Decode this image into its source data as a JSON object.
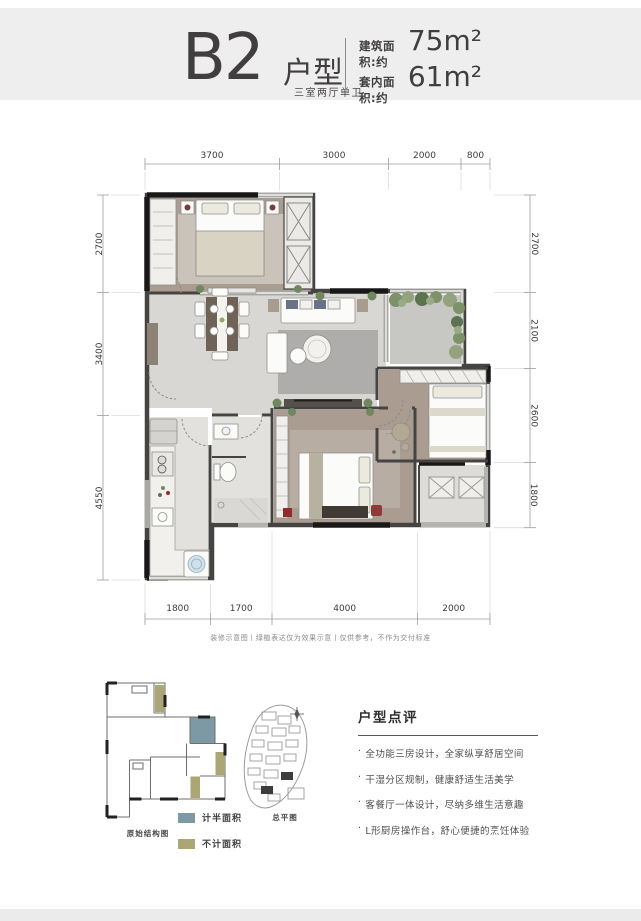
{
  "header": {
    "unit_code": "B2",
    "unit_suffix": "户型",
    "unit_subtitle": "三室两厅单卫",
    "building_area_label": "建筑面积:约",
    "building_area_value": "75m²",
    "inner_area_label": "套内面积:约",
    "inner_area_value": "61m²"
  },
  "plan": {
    "dims_top": [
      "3700",
      "3000",
      "2000",
      "800"
    ],
    "dims_left": [
      "2700",
      "3400",
      "4550"
    ],
    "dims_right": [
      "2700",
      "2100",
      "2600",
      "1800"
    ],
    "dims_bottom": [
      "1800",
      "1700",
      "4000",
      "2000"
    ],
    "disclaimer": "装修示意图丨绿植表达仅为效果示意丨仅供参考，不作为交付标准"
  },
  "thumbnails": {
    "structure_label": "原始结构图",
    "siteplan_label": "总平图"
  },
  "legend": {
    "half_area": {
      "label": "计半面积",
      "color": "#7d99a4"
    },
    "excluded_area": {
      "label": "不计面积",
      "color": "#aba674"
    }
  },
  "review": {
    "title": "户型点评",
    "marker": "·",
    "bullets": [
      "全功能三房设计，全家纵享舒居空间",
      "干湿分区规制，健康舒适生活美学",
      "客餐厅一体设计，尽纳多维生活意趣",
      "L形厨房操作台，舒心便捷的烹饪体验"
    ]
  },
  "colors": {
    "header_band": "#efeeee",
    "wall_dark": "#454442",
    "wall_black": "#181818",
    "window_gray": "#a8a8a5",
    "wood_floor": "#aa9c90",
    "tile_floor": "#e3e1de",
    "living_floor": "#d9d7d3",
    "terrace_floor": "#c7c7c4",
    "plant_green": "#70885f"
  }
}
